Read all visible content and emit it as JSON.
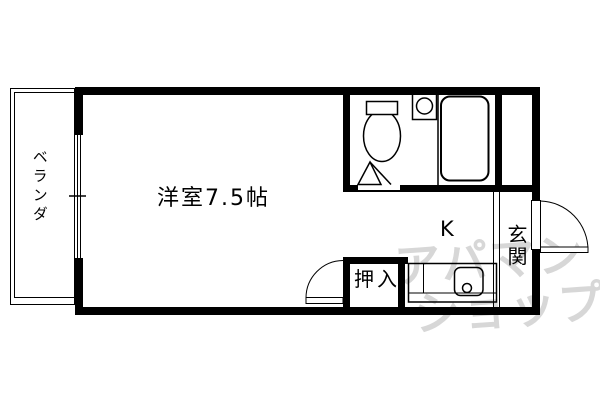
{
  "image_type": "apartment-floor-plan",
  "colors": {
    "background": "#ffffff",
    "line": "#000000",
    "watermark": "#d7d7d7"
  },
  "rooms": {
    "main": {
      "label": "洋室7.5帖"
    },
    "kitchen": {
      "label": "K"
    },
    "entrance": {
      "label": "玄関"
    },
    "closet": {
      "label": "押入"
    },
    "veranda": {
      "label": "ベランダ"
    }
  },
  "fixtures": {
    "toilet": "toilet-icon",
    "bathtub": "bathtub-icon",
    "wash_basin": "wash-basin-icon",
    "kitchen_sink": "kitchen-sink-icon",
    "entrance_door": "entrance-door-swing",
    "closet_door": "closet-door-swing",
    "bathroom_door": "bathroom-door-threshold",
    "veranda_window": "sliding-window"
  },
  "watermark": {
    "line1": "アパマン",
    "line2": "ショップ"
  }
}
